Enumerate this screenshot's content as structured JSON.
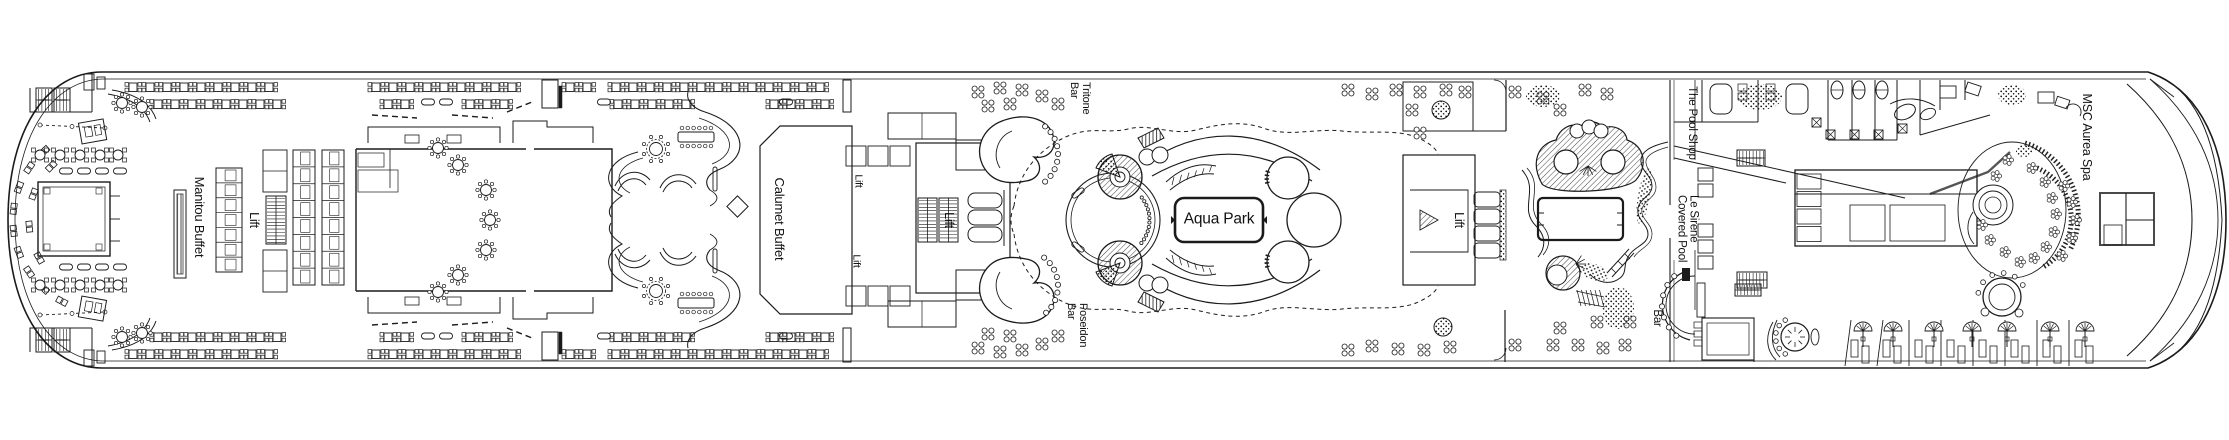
{
  "title": "Cruise ship deck plan",
  "labels": {
    "manitou_buffet": "Manitou Buffet",
    "calumet_buffet": "Calumet Buffet",
    "lift": "Lift",
    "tritone_bar": "Tritone Bar",
    "poseidon_bar": "Poseidon Bar",
    "aqua_park": "Aqua Park",
    "the_pool_shop": "The Pool Shop",
    "le_sirene_covered_pool": "Le Sirene Covered Pool",
    "bar": "Bar",
    "msc_aurea_spa": "MSC Aurea Spa"
  },
  "colors": {
    "line": "#1b1b1b",
    "background": "#ffffff"
  }
}
